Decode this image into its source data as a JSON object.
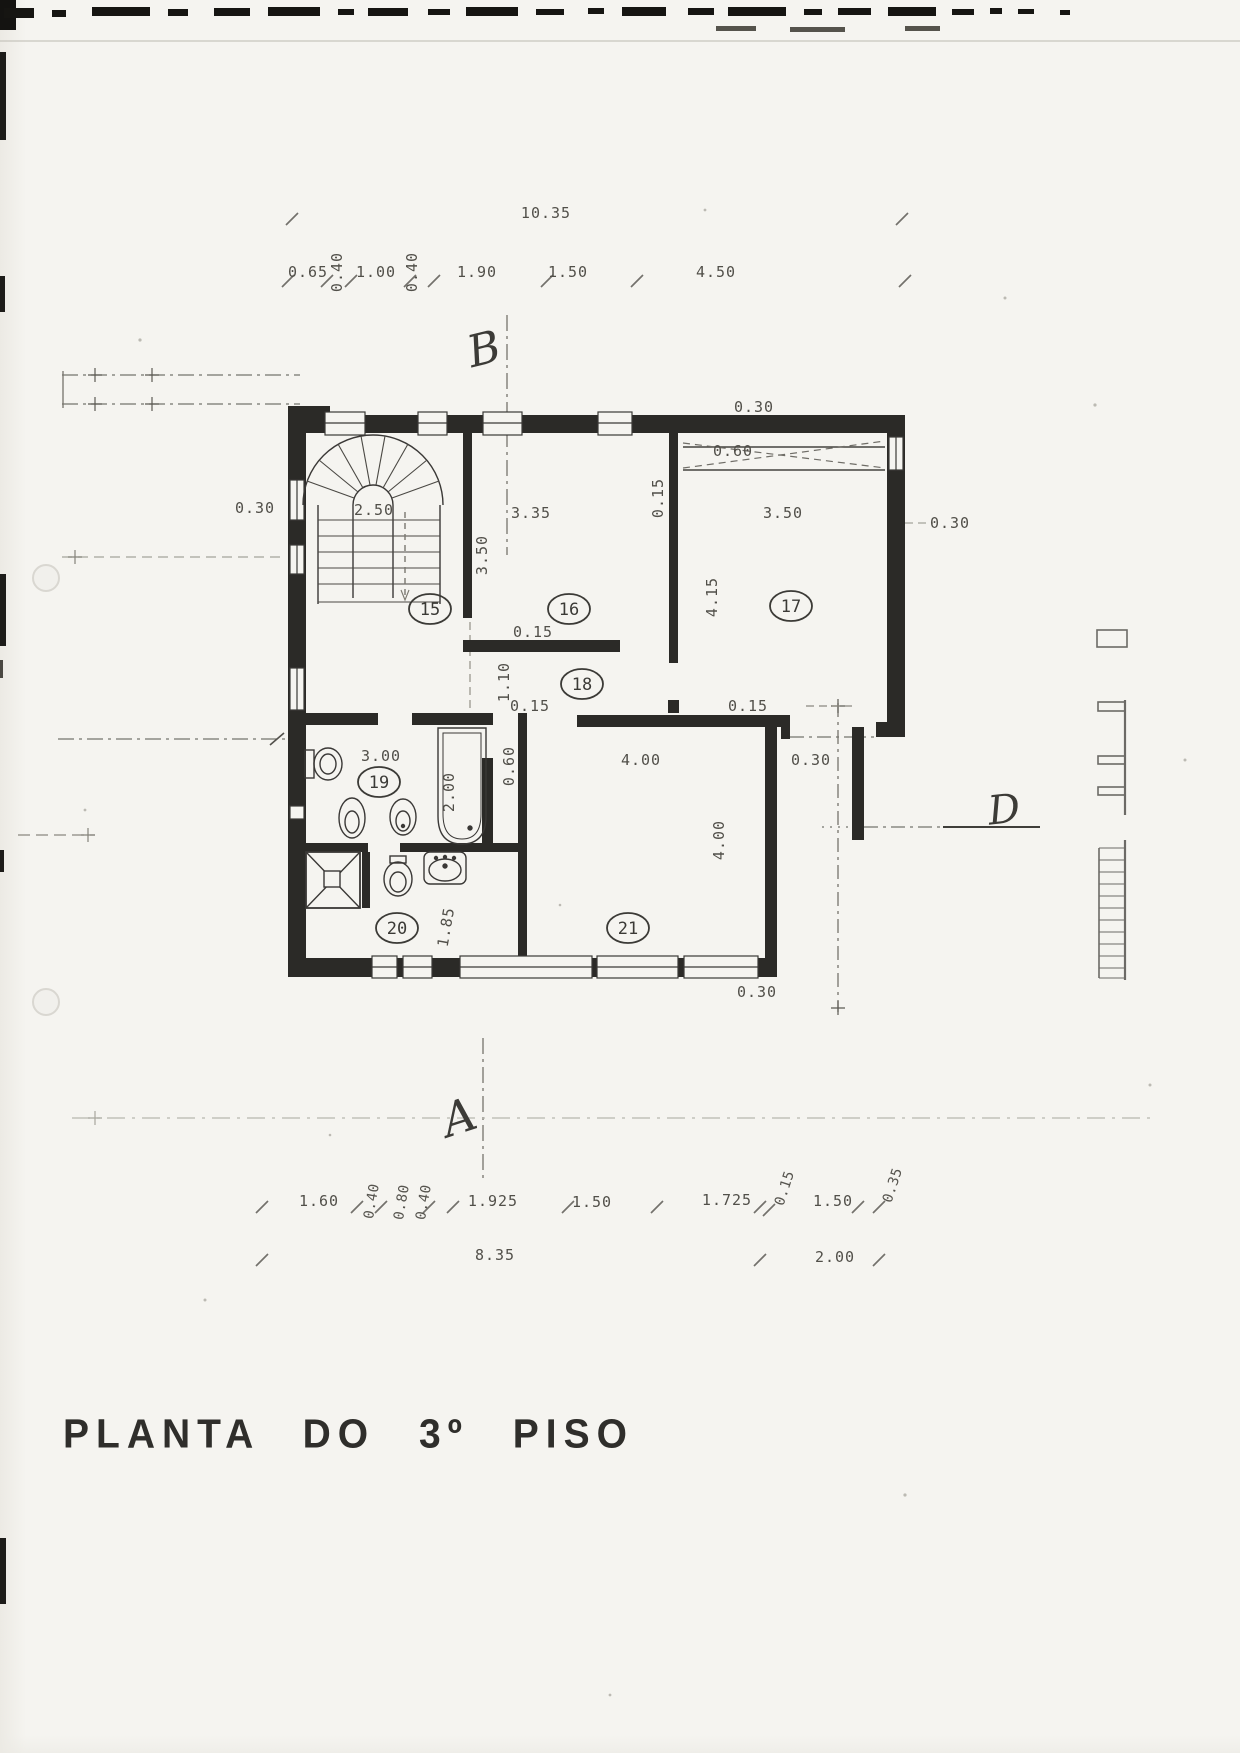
{
  "title": "PLANTA DO 3º PISO",
  "markers": {
    "b": "B",
    "a": "A",
    "d": "D"
  },
  "rooms": {
    "r15": "15",
    "r16": "16",
    "r17": "17",
    "r18": "18",
    "r19": "19",
    "r20": "20",
    "r21": "21"
  },
  "dims": {
    "top_total": "10.35",
    "top": [
      "0.65",
      "0.40",
      "1.00",
      "0.40",
      "1.90",
      "1.50",
      "4.50"
    ],
    "left_wall": "0.30",
    "right_wall": "0.30",
    "top_right_wall": "0.30",
    "door17": "0.60",
    "stair": "2.50",
    "room16_w": "3.35",
    "room16_d": "3.50",
    "part_16_17": "0.15",
    "room17_w": "3.50",
    "room17_d": "4.15",
    "wall_under16": "0.15",
    "hall_w": "1.10",
    "wall_under18": "0.15",
    "wall21_top": "0.15",
    "bath_w": "3.00",
    "tub_l": "2.00",
    "niche_w": "0.60",
    "room21_w": "4.00",
    "room21_d": "4.00",
    "balcony_wall": "0.30",
    "room20_d": "1.85",
    "bottom_right_wall": "0.30",
    "bottom": [
      "1.60",
      "0.40",
      "0.80",
      "0.40",
      "1.925",
      "1.50",
      "1.725",
      "0.15",
      "1.50",
      "0.35"
    ],
    "bottom_total_left": "8.35",
    "bottom_total_right": "2.00"
  }
}
